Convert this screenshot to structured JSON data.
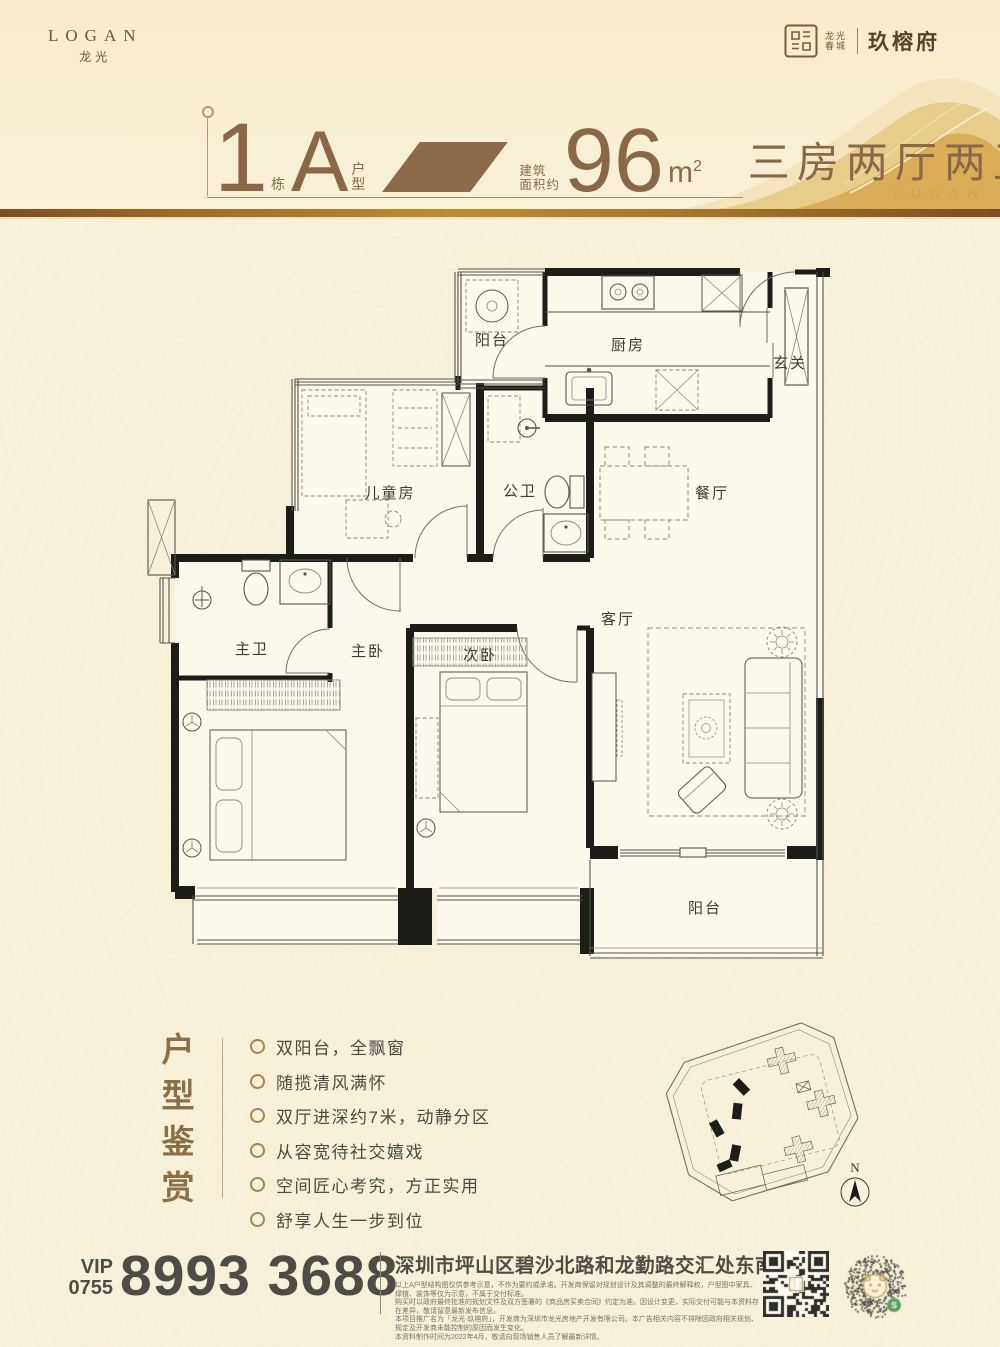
{
  "header": {
    "logo": {
      "en": "LOGAN",
      "cn": "龙光"
    },
    "project": {
      "seal_line1": "龙光",
      "seal_line2": "春城",
      "name": "玖榕府"
    },
    "watermark": "LOGAN",
    "title": {
      "building_number": "1",
      "building_suffix": "栋",
      "unit_letter": "A",
      "unit_suffix_1": "户",
      "unit_suffix_2": "型",
      "area_label_line1": "建筑",
      "area_label_line2": "面积约",
      "area_number": "96",
      "area_unit": "m",
      "area_sup": "2",
      "layout_text": "三房两厅两卫"
    }
  },
  "floorplan": {
    "labels": {
      "balcony_top": "阳台",
      "kitchen": "厨房",
      "foyer": "玄关",
      "kids_room": "儿童房",
      "guest_bath": "公卫",
      "dining": "餐厅",
      "master_bath": "主卫",
      "master_bed": "主卧",
      "second_bed": "次卧",
      "living": "客厅",
      "balcony_bottom": "阳台"
    }
  },
  "features": {
    "title": "户型鉴赏",
    "items": [
      "双阳台，全飘窗",
      "随揽清风满怀",
      "双厅进深约7米，动静分区",
      "从容宽待社交嬉戏",
      "空间匠心考究，方正实用",
      "舒享人生一步到位"
    ]
  },
  "siteplan": {
    "compass": "N"
  },
  "footer": {
    "vip_label": "VIP",
    "area_code": "0755",
    "phone": "8993 3688",
    "address": "深圳市坪山区碧沙北路和龙勤路交汇处东南角",
    "disclaimer_lines": [
      "以上A户型结构图仅供参考示意，不作为要约或承诺。开发商保留对规划设计及其调整的最终解释权，户型图中家具、绿植、装饰等仅为示意，不属于交付标准。",
      "购买时以政府最终批准的规划文件及双方签署的《商品房买卖合同》约定为准。因设计变更，实际交付可能与本资料存在差异，敬请留意最新发布信息。",
      "本项目推广名为「龙光·玖榕府」，开发商为深圳市龙光房地产开发有限公司。本广告相关内容不排除因政府相关规划、规定及开发商未能控制的原因而发生变化。",
      "本资料制作时间为2022年4月，敬请向现场销售人员了解最新详情。"
    ]
  }
}
